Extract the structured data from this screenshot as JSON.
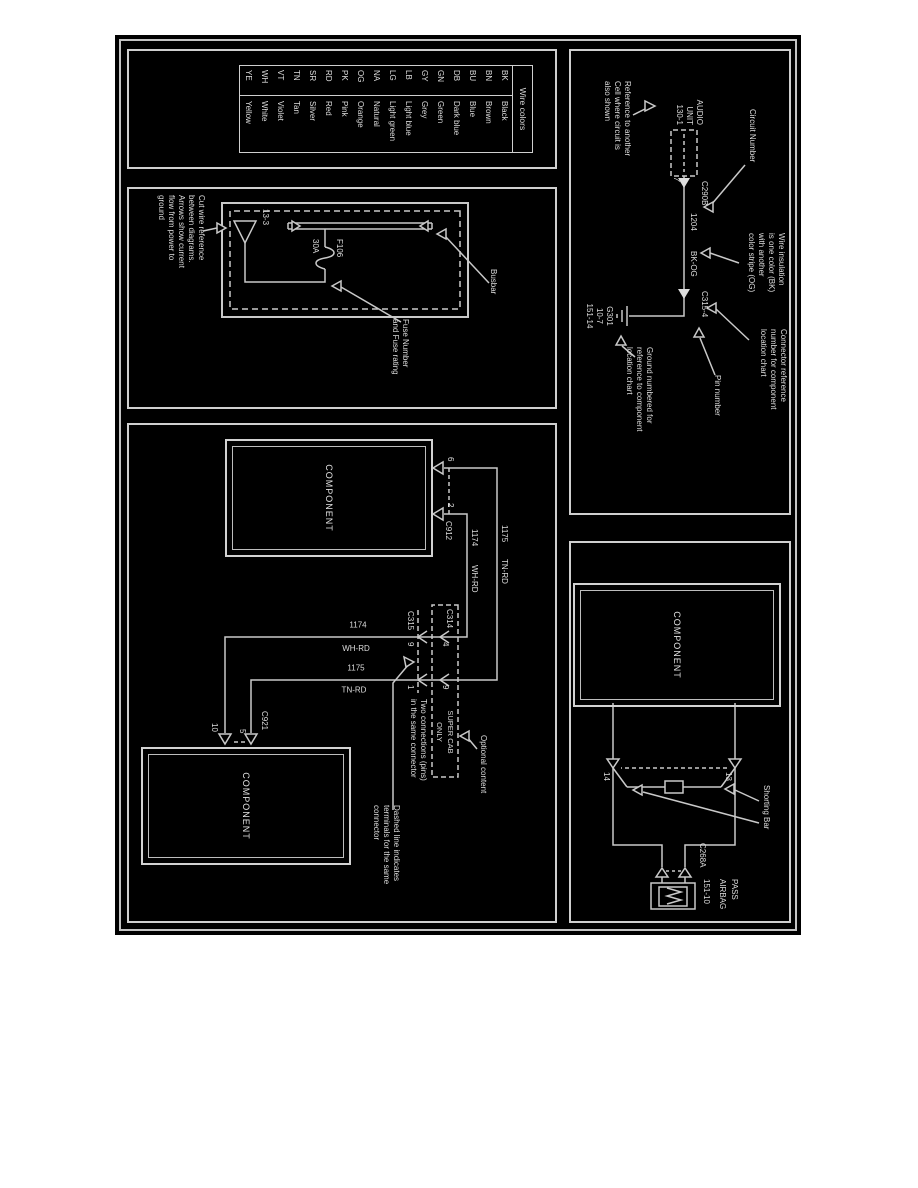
{
  "page": {
    "background": "#ffffff",
    "diagram_background": "#000000",
    "line_color": "#c8c8c8",
    "text_color": "#dddddd"
  },
  "wire_colors": {
    "title": "Wire colors",
    "rows": [
      [
        "BK",
        "Black"
      ],
      [
        "BN",
        "Brown"
      ],
      [
        "BU",
        "Blue"
      ],
      [
        "DB",
        "Dark blue"
      ],
      [
        "GN",
        "Green"
      ],
      [
        "GY",
        "Grey"
      ],
      [
        "LB",
        "Light blue"
      ],
      [
        "LG",
        "Light green"
      ],
      [
        "NA",
        "Natural"
      ],
      [
        "OG",
        "Orange"
      ],
      [
        "PK",
        "Pink"
      ],
      [
        "RD",
        "Red"
      ],
      [
        "SR",
        "Silver"
      ],
      [
        "TN",
        "Tan"
      ],
      [
        "VT",
        "Violet"
      ],
      [
        "WH",
        "White"
      ],
      [
        "YE",
        "Yellow"
      ]
    ]
  },
  "fuse_panel": {
    "cut_wire_note": "Cut wire reference\nbetween diagrams.\nArrows show current\nflow from power to\nground",
    "triangle_ref": "13-3",
    "fuse_number": "F106",
    "fuse_rating": "30A",
    "busbar_label": "Busbar",
    "fuse_callout": "Fuse Number\nand Fuse rating"
  },
  "audio_panel": {
    "component_name": "AUDIO\nUNIT\n130-1",
    "connector_a": "C290B",
    "pin_a": "7",
    "circuit_number": "1204",
    "wire_color": "BK-OG",
    "connector_b": "C315-4",
    "ground_block": "G301\n10-7\n151-14",
    "callout_reference": "Reference to another\nCell where circuit is\nalso shown",
    "callout_circuit": "Circuit Number",
    "callout_insulation": "Wire insulation\nis one color (BK)\nwith another\ncolor stripe (OG)",
    "callout_connector": "Connector reference\nnumber for component\nlocation chart",
    "callout_pin": "Pin number",
    "callout_ground": "Ground numbered for\nreference to component\nlocation chart"
  },
  "components_panel": {
    "component_1": "COMPONENT",
    "component_2": "COMPONENT",
    "connector_top": "C912",
    "pin_6": "6",
    "pin_2": "2",
    "connector_bottom": "C921",
    "pin_5": "5",
    "pin_10": "10",
    "wire_1175": "1175",
    "wire_1175_color": "TN-RD",
    "wire_1174": "1174",
    "wire_1174_color": "WH-RD",
    "c314": "C314",
    "c315": "C315",
    "pin_c314_on_1174": "4",
    "pin_c315_on_1174": "9",
    "pin_c314_on_1175": "9",
    "pin_c315_on_1175": "1",
    "super_cab": "SUPER CAB\nONLY",
    "callout_two_connections": "Two connections (pins)\nin the same connector",
    "callout_optional": "Optional content",
    "callout_dashed": "Dashed line indicates\nterminals for the same\nconnector"
  },
  "airbag_panel": {
    "component": "COMPONENT",
    "pin_13": "13",
    "pin_14": "14",
    "shorting_bar": "Shorting Bar",
    "connector": "C268A",
    "name_line_1": "PASS",
    "name_line_2": "AIRBAG",
    "location_ref": "151-10"
  }
}
